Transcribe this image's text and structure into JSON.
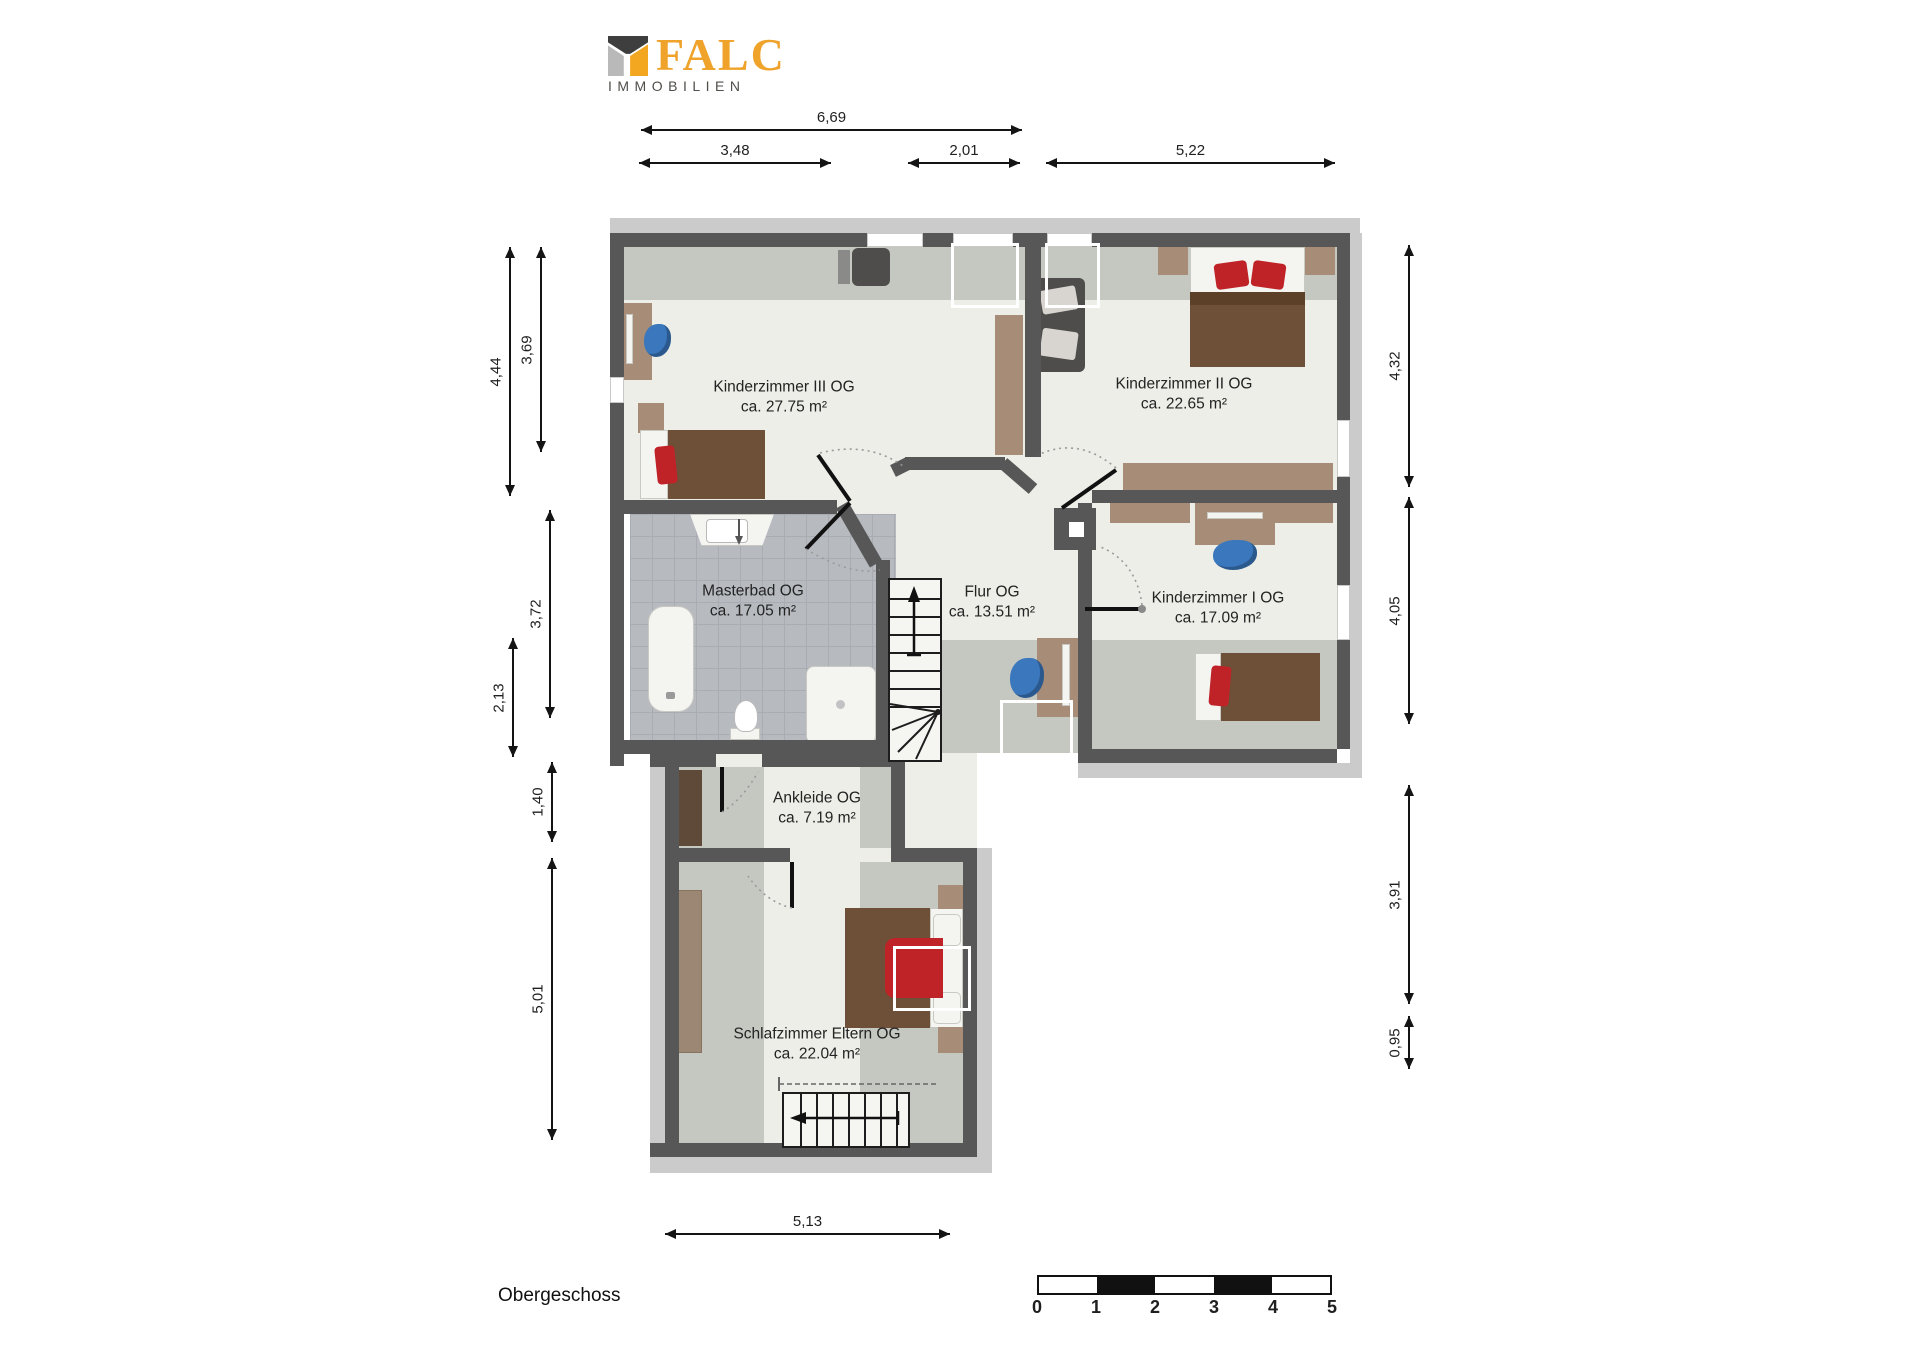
{
  "logo": {
    "name": "FALC",
    "subtitle": "IMMOBILIEN"
  },
  "title": "Obergeschoss",
  "rooms": [
    {
      "name": "Kinderzimmer III OG",
      "area": "ca. 27.75 m²"
    },
    {
      "name": "Kinderzimmer II OG",
      "area": "ca. 22.65 m²"
    },
    {
      "name": "Masterbad OG",
      "area": "ca. 17.05 m²"
    },
    {
      "name": "Flur OG",
      "area": "ca. 13.51 m²"
    },
    {
      "name": "Kinderzimmer I OG",
      "area": "ca. 17.09 m²"
    },
    {
      "name": "Ankleide OG",
      "area": "ca. 7.19 m²"
    },
    {
      "name": "Schlafzimmer Eltern OG",
      "area": "ca. 22.04 m²"
    }
  ],
  "dims": {
    "top": [
      "6,69",
      "3,48",
      "2,01",
      "5,22"
    ],
    "left": [
      "4,44",
      "3,69",
      "3,72",
      "2,13",
      "1,40",
      "5,01"
    ],
    "right": [
      "4,32",
      "4,05",
      "3,91",
      "0,95"
    ],
    "bottom": [
      "5,13"
    ]
  },
  "scale": {
    "labels": [
      "0",
      "1",
      "2",
      "3",
      "4",
      "5"
    ]
  },
  "colors": {
    "accent_orange": "#EFA32B",
    "wall": "#575757",
    "floor": "#ECEEE7",
    "low_ceiling_band": "#C5C7C1",
    "roof_band": "#CBCBCB",
    "bath_tile": "#B7BBC0",
    "wood": "#A78C77",
    "wood_dark": "#6E4F38",
    "wardrobe_dark": "#5F4A3A",
    "pillow_red": "#BF2328",
    "chair_blue": "#3A77BD",
    "sofa_gray": "#4E4D4B"
  }
}
